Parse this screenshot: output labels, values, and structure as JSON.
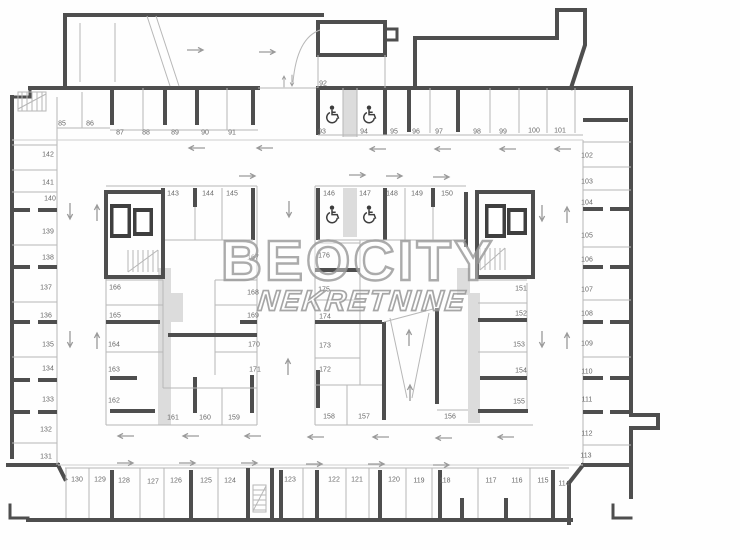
{
  "watermark": {
    "line1": "BEOCITY",
    "line2": "NEKRETNINE"
  },
  "colors": {
    "wall": "#4e4e4e",
    "thin_line": "#b7b7b7",
    "label": "#686868",
    "shading": "#dcdcdc",
    "watermark_outline": "#969696",
    "background": "#ffffff"
  },
  "icons": {
    "accessible": "wheelchair-icon",
    "stairs": "stairs-icon",
    "elevator": "elevator-icon",
    "flow_arrow": "arrow-icon",
    "ladder": "ladder-icon"
  },
  "floor_plan": {
    "accessible_spot_numbers": [
      "93",
      "94",
      "146",
      "147"
    ],
    "spots": [
      [
        "85",
        62,
        124
      ],
      [
        "86",
        90,
        124
      ],
      [
        "87",
        120,
        133
      ],
      [
        "88",
        146,
        133
      ],
      [
        "89",
        175,
        133
      ],
      [
        "90",
        205,
        133
      ],
      [
        "91",
        232,
        133
      ],
      [
        "92",
        323,
        84
      ],
      [
        "93",
        322,
        132
      ],
      [
        "94",
        364,
        132
      ],
      [
        "95",
        394,
        132
      ],
      [
        "96",
        416,
        132
      ],
      [
        "97",
        439,
        132
      ],
      [
        "98",
        477,
        132
      ],
      [
        "99",
        503,
        132
      ],
      [
        "100",
        534,
        131
      ],
      [
        "101",
        560,
        131
      ],
      [
        "102",
        587,
        156
      ],
      [
        "103",
        587,
        182
      ],
      [
        "104",
        587,
        203
      ],
      [
        "105",
        587,
        236
      ],
      [
        "106",
        587,
        260
      ],
      [
        "107",
        587,
        290
      ],
      [
        "108",
        587,
        314
      ],
      [
        "109",
        587,
        344
      ],
      [
        "110",
        587,
        372
      ],
      [
        "111",
        587,
        400
      ],
      [
        "112",
        587,
        434
      ],
      [
        "113",
        586,
        456
      ],
      [
        "114",
        564,
        484
      ],
      [
        "115",
        543,
        481
      ],
      [
        "116",
        517,
        481
      ],
      [
        "117",
        491,
        481
      ],
      [
        "118",
        445,
        481
      ],
      [
        "119",
        419,
        481
      ],
      [
        "120",
        394,
        480
      ],
      [
        "121",
        357,
        480
      ],
      [
        "122",
        334,
        480
      ],
      [
        "123",
        290,
        480
      ],
      [
        "124",
        230,
        481
      ],
      [
        "125",
        206,
        481
      ],
      [
        "126",
        176,
        481
      ],
      [
        "127",
        153,
        482
      ],
      [
        "128",
        124,
        481
      ],
      [
        "129",
        100,
        480
      ],
      [
        "130",
        77,
        480
      ],
      [
        "131",
        46,
        457
      ],
      [
        "132",
        46,
        430
      ],
      [
        "133",
        48,
        400
      ],
      [
        "134",
        48,
        369
      ],
      [
        "135",
        48,
        345
      ],
      [
        "136",
        46,
        316
      ],
      [
        "137",
        46,
        288
      ],
      [
        "138",
        48,
        258
      ],
      [
        "139",
        48,
        232
      ],
      [
        "140",
        50,
        199
      ],
      [
        "141",
        48,
        183
      ],
      [
        "142",
        48,
        155
      ],
      [
        "143",
        173,
        194
      ],
      [
        "144",
        208,
        194
      ],
      [
        "145",
        232,
        194
      ],
      [
        "146",
        329,
        194
      ],
      [
        "147",
        365,
        194
      ],
      [
        "148",
        392,
        194
      ],
      [
        "149",
        417,
        194
      ],
      [
        "150",
        447,
        194
      ],
      [
        "151",
        521,
        289
      ],
      [
        "152",
        521,
        314
      ],
      [
        "153",
        519,
        345
      ],
      [
        "154",
        521,
        371
      ],
      [
        "155",
        519,
        402
      ],
      [
        "156",
        450,
        417
      ],
      [
        "157",
        364,
        417
      ],
      [
        "158",
        329,
        417
      ],
      [
        "159",
        234,
        418
      ],
      [
        "160",
        205,
        418
      ],
      [
        "161",
        173,
        418
      ],
      [
        "162",
        114,
        401
      ],
      [
        "163",
        114,
        370
      ],
      [
        "164",
        114,
        345
      ],
      [
        "165",
        115,
        316
      ],
      [
        "166",
        115,
        288
      ],
      [
        "167",
        253,
        258
      ],
      [
        "168",
        253,
        293
      ],
      [
        "169",
        253,
        316
      ],
      [
        "170",
        254,
        345
      ],
      [
        "171",
        255,
        370
      ],
      [
        "172",
        325,
        370
      ],
      [
        "173",
        325,
        346
      ],
      [
        "174",
        325,
        317
      ],
      [
        "175",
        324,
        290
      ],
      [
        "176",
        324,
        256
      ]
    ]
  }
}
